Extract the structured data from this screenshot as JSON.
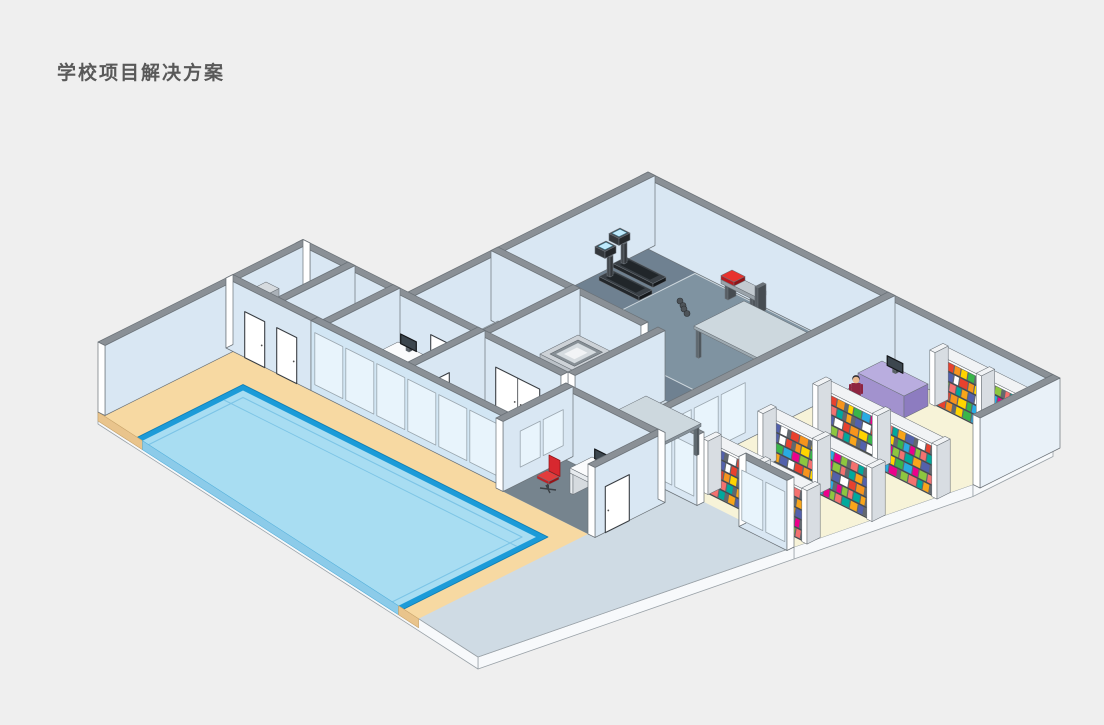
{
  "title": "学校项目解决方案",
  "colors": {
    "bg": "#efefef",
    "titleColor": "#595959",
    "line": "#6b7278",
    "wallTop": "#8a9096",
    "wallFace": "#d9e7f3",
    "wallFaceLight": "#e8f1f8",
    "wallExt": "#e9f1f8",
    "cut": "#ffffff",
    "glass": "#e8f4fc",
    "glassFrame": "#9aa6af",
    "slabTop": "#cfdbe4",
    "slabSide": "#f7f9fb",
    "gymFloor": "#6f8191",
    "gymMat": "#7f93a1",
    "matLine": "#cfd8de",
    "stairsFloor": "#e3eaf0",
    "kitchenFloor": "#eaf0f4",
    "libraryFloor": "#f7f3d8",
    "wingFloor": "#eef3f7",
    "deck": "#f7d9a2",
    "deckFace": "#e9c48c",
    "officeFloor": "#76848e",
    "poolEdge": "#1c9bd8",
    "water": "#a8ddf2",
    "waterFace": "#8ccbe9",
    "waterLine": "#7cc4e6",
    "deskPurpleTop": "#b9addf",
    "deskPurpleL": "#a292ce",
    "deskPurpleR": "#8d7cc0",
    "benchRed": "#e8322e",
    "chairRed": "#d7282f",
    "steel": "#cdd2d7",
    "treadmill": "#3a4046",
    "screenCyan": "#bfe9fb",
    "tableTop": "#cdd8de",
    "tableSide": "#9fabb2",
    "legDark": "#5f6970",
    "cabinetTop": "#d6dbdf",
    "cabinetFace": "#c6ccd2",
    "cabinetSide": "#aab1b8",
    "skin": "#ecb98e",
    "hair": "#2f2f33",
    "monitor": "#24292d"
  },
  "book_palette": [
    "#e8412e",
    "#f7941d",
    "#ffd400",
    "#39b54a",
    "#29abe2",
    "#ec008c",
    "#8dc63f",
    "#f4716f",
    "#00a99d",
    "#f9a51a",
    "#5361ac",
    "#ffffff"
  ],
  "people": [
    {
      "id": "person-wing-office",
      "shirt": "#2b7bc5",
      "pants": "#17324f"
    },
    {
      "id": "person-hallway",
      "shirt": "#2ba84e",
      "pants": "#2b2f33"
    },
    {
      "id": "person-library",
      "shirt": "#8e2440",
      "pants": "#26262a"
    }
  ],
  "rooms": [
    "pool-hall",
    "gym",
    "library",
    "hallway",
    "kitchen",
    "stairwell",
    "storage-room",
    "wing-office",
    "front-office"
  ]
}
